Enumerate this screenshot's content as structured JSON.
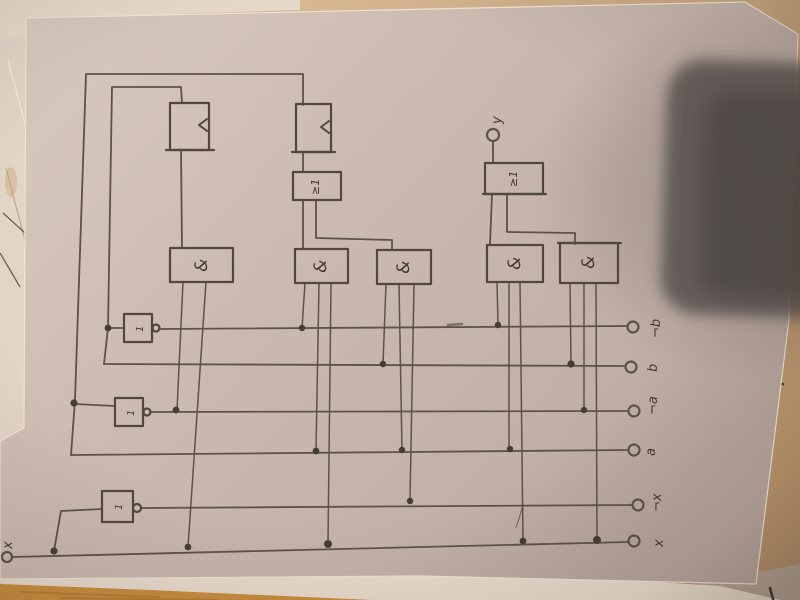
{
  "circuit": {
    "and_label": "&",
    "or_label": "≥1",
    "not_label": "1",
    "output_label": "y",
    "input_x_label": "x",
    "terminal_labels": [
      "¬b",
      "b",
      "¬a",
      "a",
      "¬x",
      "x"
    ]
  },
  "colors": {
    "paper": "#cbbab0",
    "pencil": "#5c5248",
    "table_wood": "#c88d3e",
    "table_tan": "#c9a67e",
    "under_sheet": "#e6d8ca",
    "camera_shadow": "#4f4845"
  }
}
